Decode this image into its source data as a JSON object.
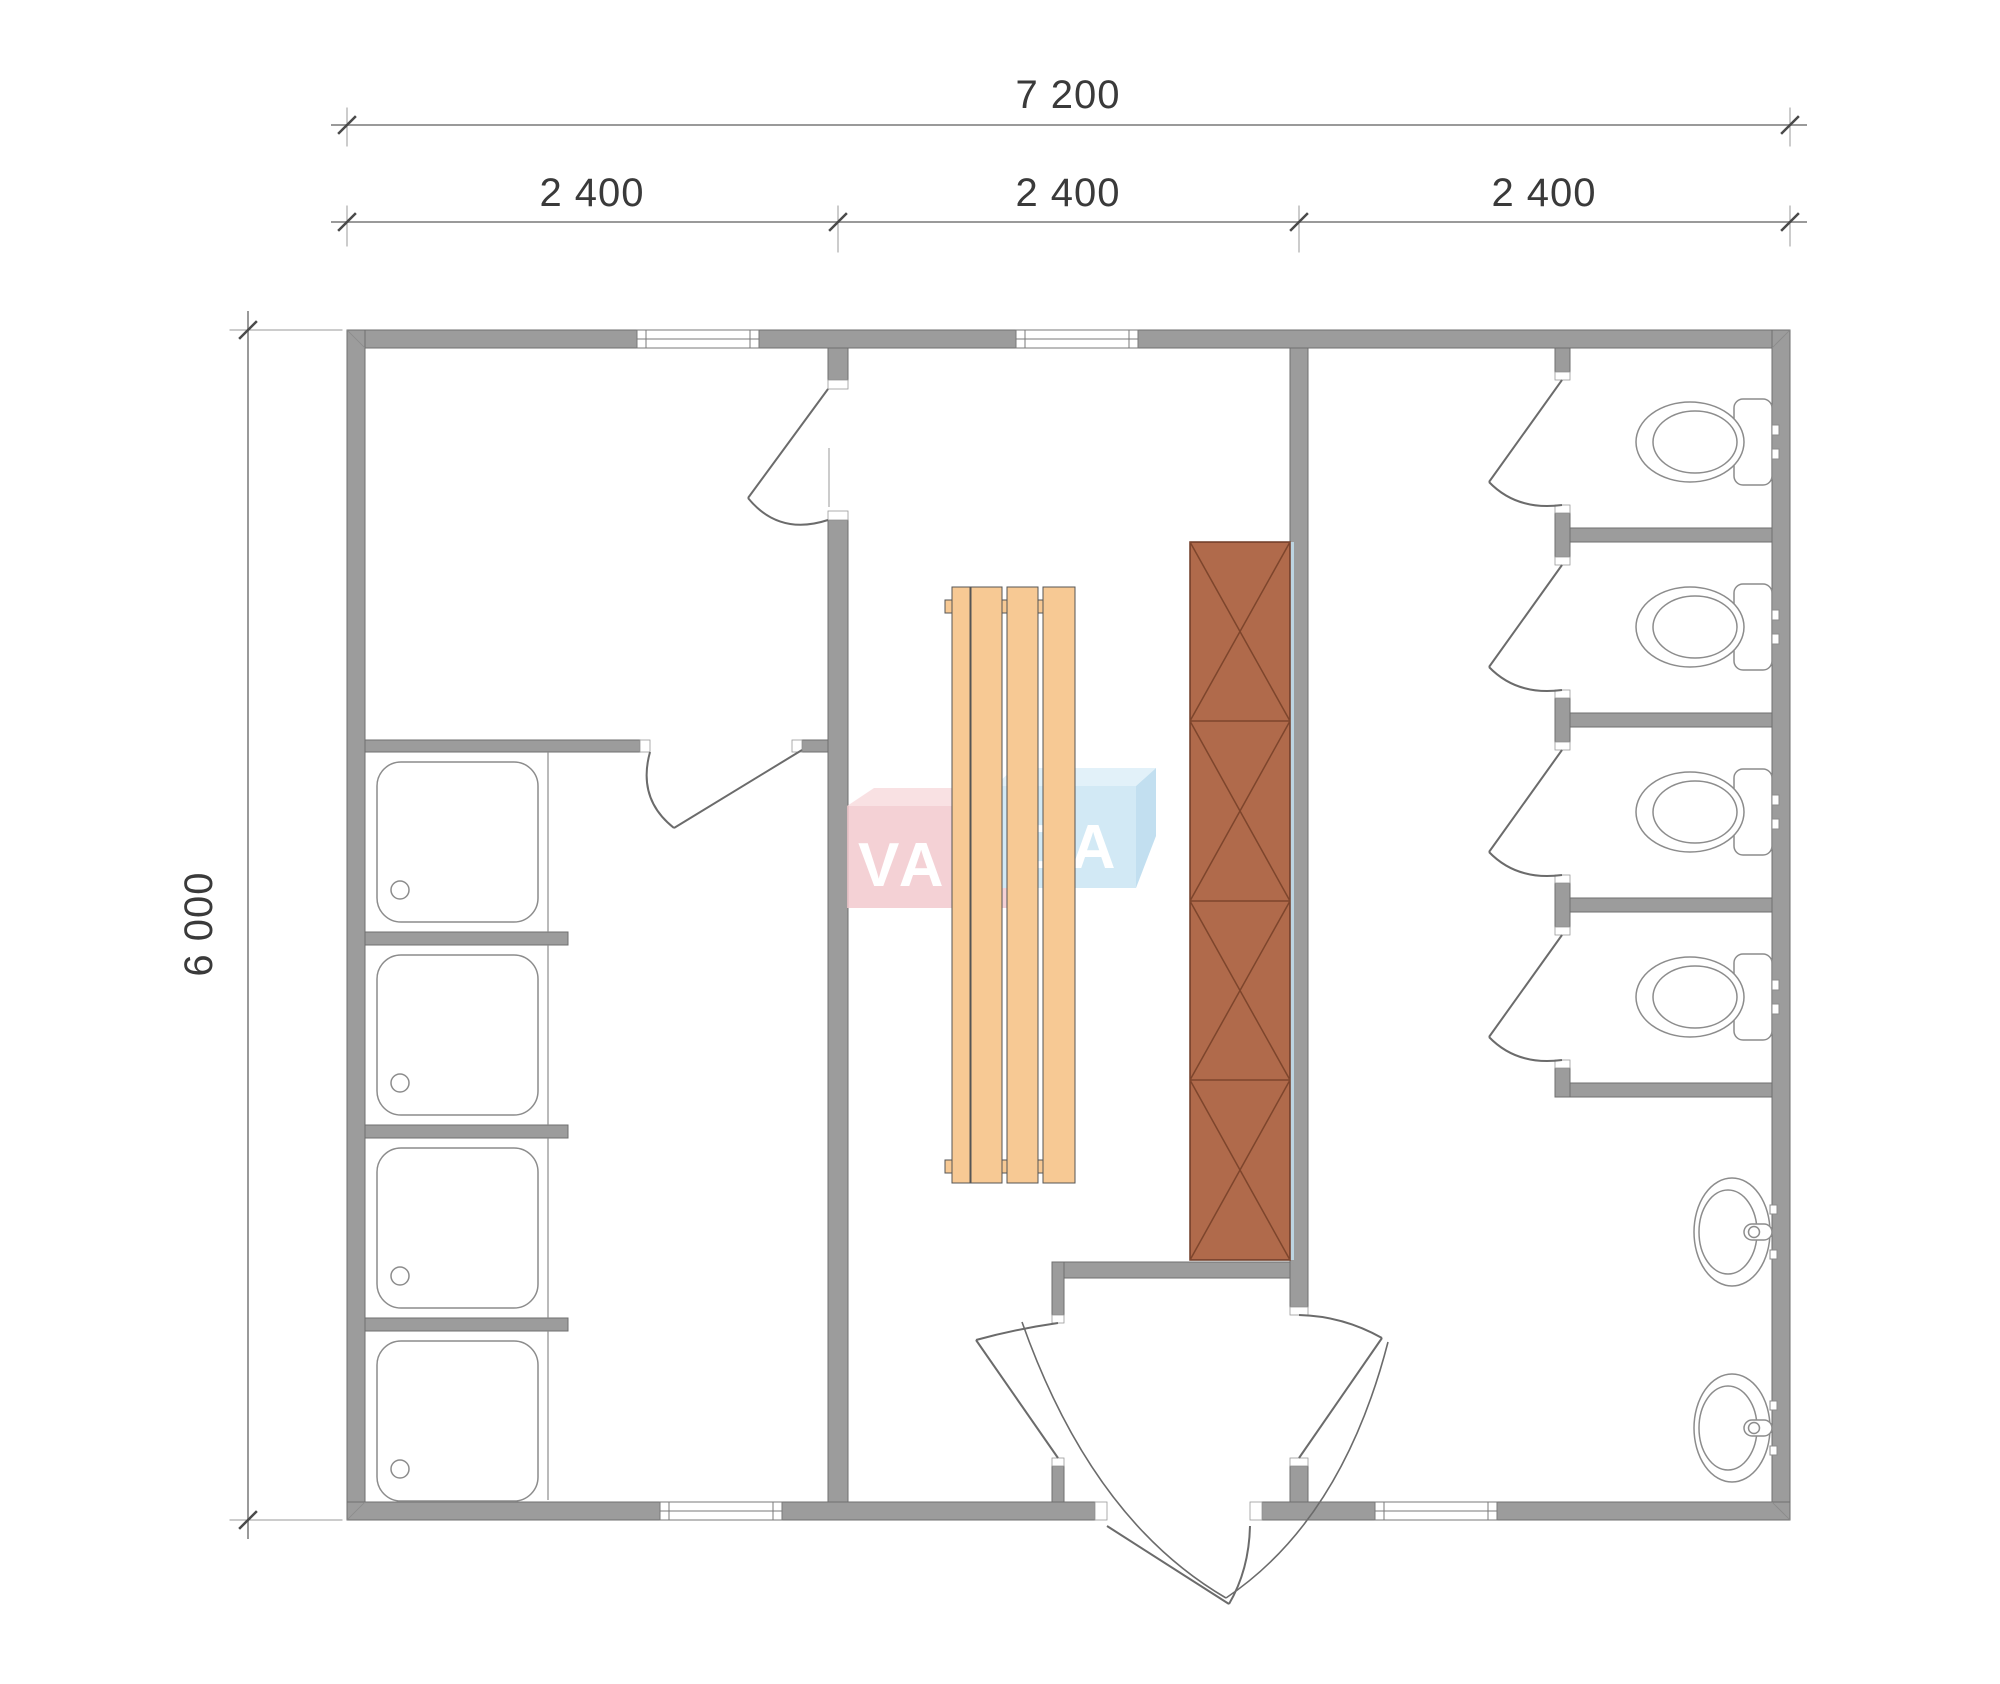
{
  "plan": {
    "dimensions": {
      "total_width_label": "7 200",
      "module_labels": [
        "2 400",
        "2 400",
        "2 400"
      ],
      "total_height_label": "6 000"
    },
    "watermark": {
      "brand_left": "VAN",
      "brand_right": "DA"
    },
    "contents": {
      "shower_cabins": 4,
      "toilet_stalls": 4,
      "washbasins": 2,
      "bench_planks": 4,
      "sauna_heater_segments": 4,
      "windows": 4,
      "entrance_doors": 1
    }
  },
  "colors": {
    "wall": "#9c9c9c",
    "wall_outline": "#6f6f6f",
    "jamb": "#ffffff",
    "door": "#6b6b6b",
    "fixture": "#8c8c8c",
    "bench": "#f7c994",
    "bench_outline": "#555555",
    "heater": "#b06a4b",
    "heater_outline": "#6e3b27",
    "heater_pattern": "#7d452c",
    "ledge": "#bdd5e2",
    "logo_pink": "#f2c8cd",
    "logo_pink_top": "#f8dbde",
    "logo_red": "#ef5a49",
    "logo_red_top": "#e2543f",
    "logo_blue": "#c9e5f3",
    "logo_blue_top": "#dceff8",
    "logo_blue_side": "#b5d9ed",
    "dim_line": "#9a9a9a",
    "dim_tick": "#4a4a4a",
    "dim_text": "#3a3a3a"
  }
}
